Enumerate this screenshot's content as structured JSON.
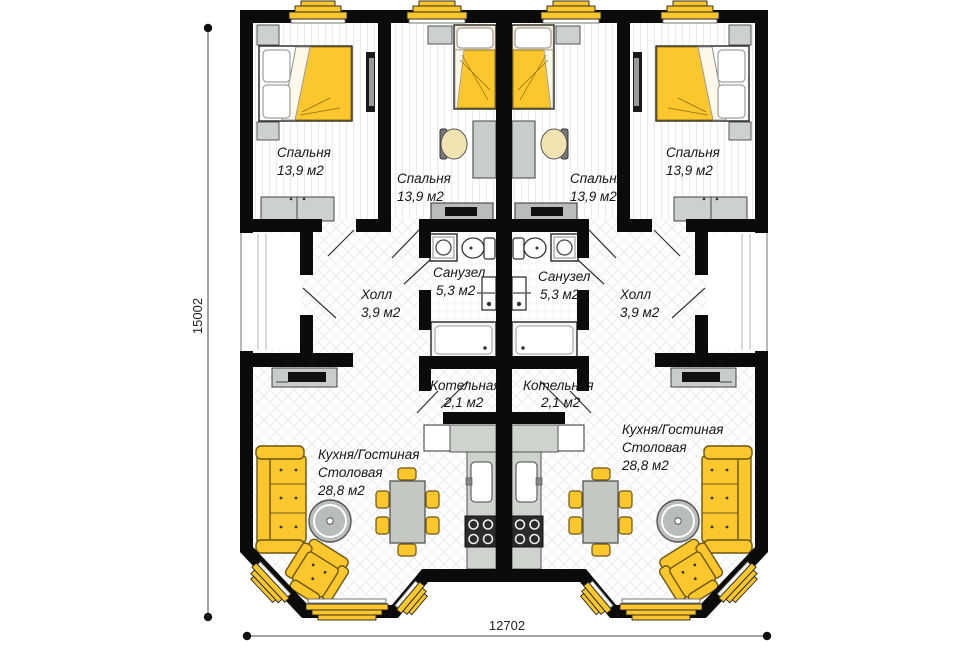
{
  "plan": {
    "dimension_labels": {
      "vertical": "15002",
      "horizontal": "12702"
    },
    "units": {
      "left": {
        "bedroom_outer": {
          "name": "Спальня",
          "area": "13,9 м2"
        },
        "bedroom_inner": {
          "name": "Спальня",
          "area": "13,9 м2"
        },
        "hall": {
          "name": "Холл",
          "area": "3,9 м2"
        },
        "bathroom": {
          "name": "Санузел",
          "area": "5,3 м2"
        },
        "boiler_room": {
          "name": "Котельная",
          "area": "2,1 м2"
        },
        "kitchen_living": {
          "line1": "Кухня/Гостиная",
          "line2": "Столовая",
          "area": "28,8 м2"
        }
      },
      "right": {
        "bedroom_outer": {
          "name": "Спальня",
          "area": "13,9 м2"
        },
        "bedroom_inner": {
          "name": "Спальня",
          "area": "13,9 м2"
        },
        "hall": {
          "name": "Холл",
          "area": "3,9 м2"
        },
        "bathroom": {
          "name": "Санузел",
          "area": "5,3 м2"
        },
        "boiler_room": {
          "name": "Котельная",
          "area": "2,1 м2"
        },
        "kitchen_living": {
          "line1": "Кухня/Гостиная",
          "line2": "Столовая",
          "area": "28,8 м2"
        }
      }
    },
    "colors": {
      "accent_yellow": "#fcc62d",
      "wall_black": "#0b0b0b",
      "furniture_gray": "#c9cdc9"
    }
  }
}
